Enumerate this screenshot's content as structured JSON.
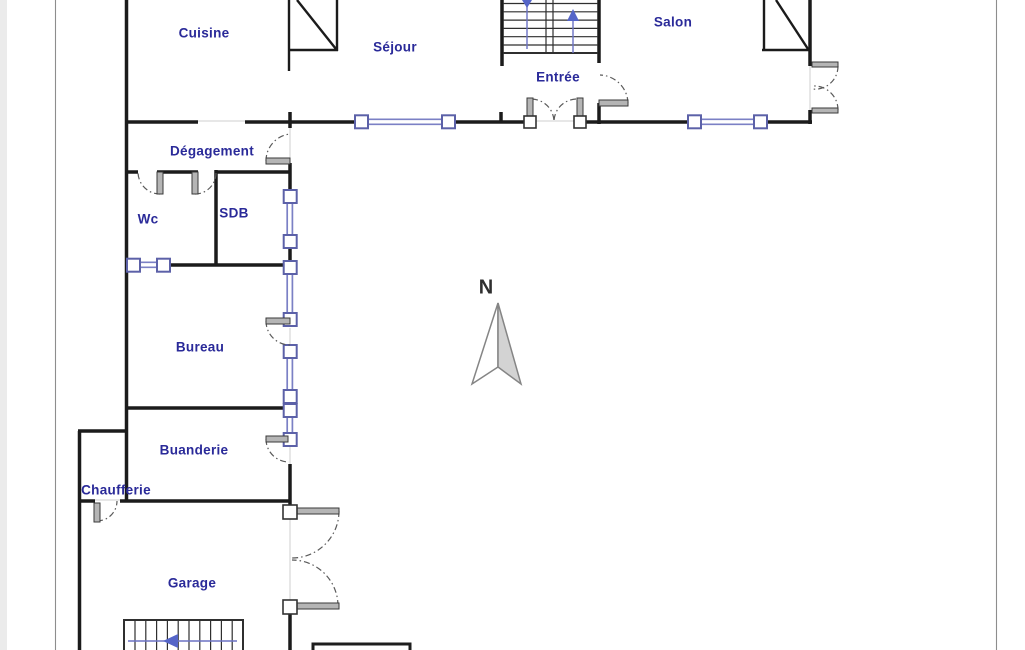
{
  "rooms": {
    "cuisine": {
      "label": "Cuisine"
    },
    "sejour": {
      "label": "Séjour"
    },
    "entree": {
      "label": "Entrée"
    },
    "salon": {
      "label": "Salon"
    },
    "degagement": {
      "label": "Dégagement"
    },
    "wc": {
      "label": "Wc"
    },
    "sdb": {
      "label": "SDB"
    },
    "bureau": {
      "label": "Bureau"
    },
    "buanderie": {
      "label": "Buanderie"
    },
    "chaufferie": {
      "label": "Chaufferie"
    },
    "garage": {
      "label": "Garage"
    }
  },
  "compass": {
    "label": "N"
  },
  "icons": {
    "upper_stair_left_arrow": "arrow-down-icon",
    "upper_stair_right_arrow": "arrow-up-icon",
    "garage_stair_arrow": "arrow-left-icon",
    "north_pointer": "north-arrow-icon"
  },
  "colors": {
    "wall": "#1b1b1b",
    "label_text": "#2a2a99",
    "window_accent": "#7b80c5",
    "window_frame": "#5c61a8",
    "door_leaf": "#b5b5b5",
    "stair_line": "#6b72c4",
    "stair_arrow": "#5565c8",
    "compass_fill": "#d3d3d3",
    "page_line": "#8d8d8d"
  }
}
